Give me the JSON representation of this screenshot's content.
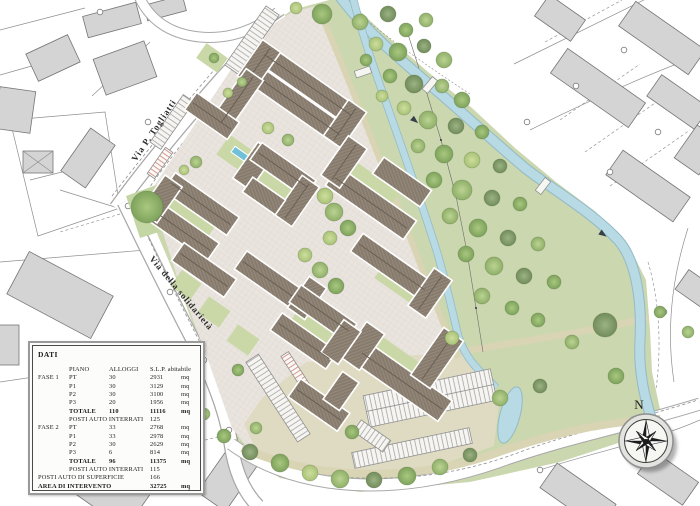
{
  "map": {
    "street_labels": {
      "via_togliatti": "Via P. Togliatti",
      "via_solidarieta": "Via della solidarietà"
    },
    "compass": {
      "north_label": "N"
    },
    "colors": {
      "roof": "#8a7e70",
      "roof_ridge": "#665c50",
      "paving": "#eae4de",
      "courtyard_green": "#c9d8a6",
      "park_green": "#cbd7ae",
      "water": "#b7dae4",
      "existing_building": "#d4d4d4",
      "parking_surface": "#dfdbc2"
    }
  },
  "data_table": {
    "title": "DATI",
    "columns": {
      "piano": "PIANO",
      "alloggi": "ALLOGGI",
      "slp": "S.L.P. abitabile"
    },
    "rows": [
      {
        "c1": "FASE 1",
        "c2": "PT",
        "c3": "30",
        "c4": "2931",
        "c5": "mq"
      },
      {
        "c1": "",
        "c2": "P1",
        "c3": "30",
        "c4": "3129",
        "c5": "mq"
      },
      {
        "c1": "",
        "c2": "P2",
        "c3": "30",
        "c4": "3100",
        "c5": "mq"
      },
      {
        "c1": "",
        "c2": "P3",
        "c3": "20",
        "c4": "1956",
        "c5": "mq"
      },
      {
        "c1": "",
        "c2": "TOTALE",
        "c3": "110",
        "c4": "11116",
        "c5": "mq"
      },
      {
        "c1": "",
        "c2": "POSTI AUTO INTERRATI",
        "c3": "",
        "c4": "125",
        "c5": ""
      },
      {
        "c1": "FASE 2",
        "c2": "PT",
        "c3": "33",
        "c4": "2768",
        "c5": "mq"
      },
      {
        "c1": "",
        "c2": "P1",
        "c3": "33",
        "c4": "2978",
        "c5": "mq"
      },
      {
        "c1": "",
        "c2": "P2",
        "c3": "30",
        "c4": "2629",
        "c5": "mq"
      },
      {
        "c1": "",
        "c2": "P3",
        "c3": "6",
        "c4": "814",
        "c5": "mq"
      },
      {
        "c1": "",
        "c2": "TOTALE",
        "c3": "96",
        "c4": "11375",
        "c5": "mq"
      },
      {
        "c1": "",
        "c2": "POSTI AUTO INTERRATI",
        "c3": "",
        "c4": "115",
        "c5": ""
      },
      {
        "c1": "POSTI AUTO DI SUPERFICIE",
        "c4": "166",
        "c5": ""
      },
      {
        "c1": "AREA DI INTERVENTO",
        "c4": "32725",
        "c5": "mq"
      }
    ]
  }
}
